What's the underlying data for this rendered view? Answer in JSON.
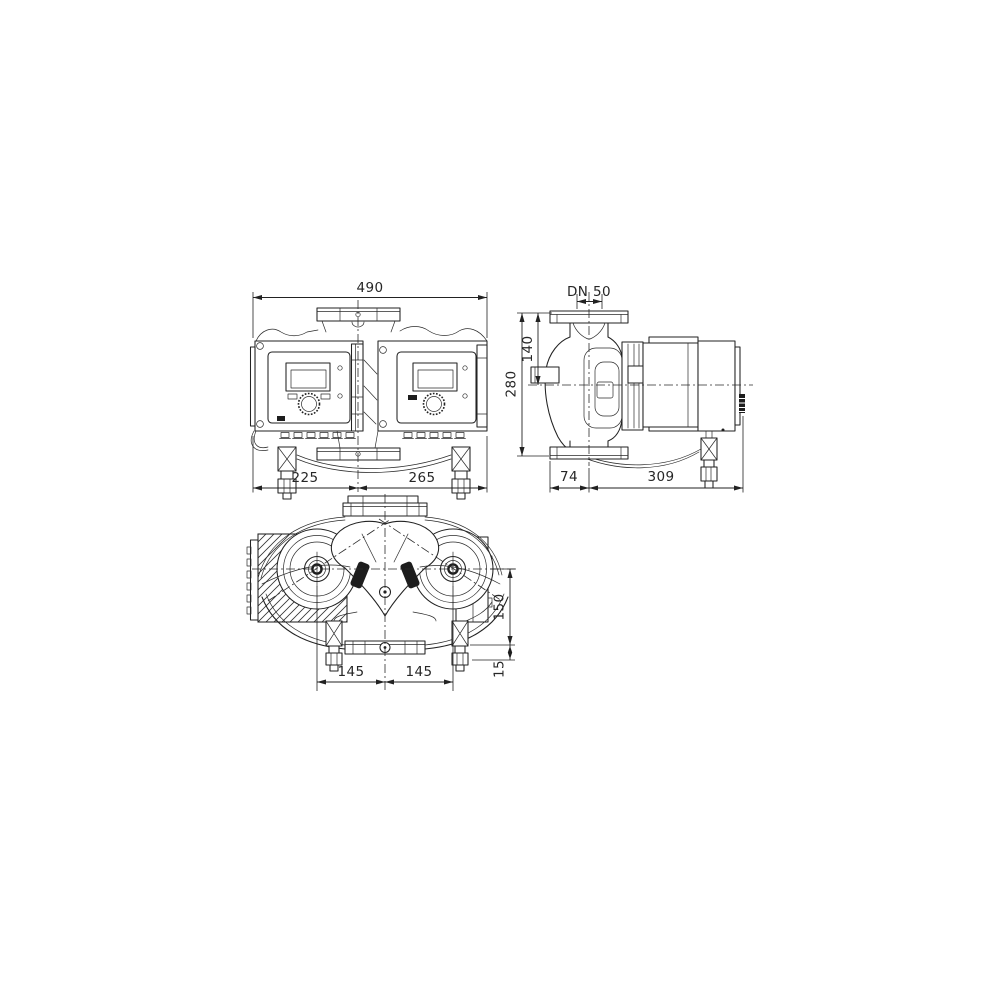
{
  "drawing": {
    "background": "#ffffff",
    "line_color": "#222222",
    "views": {
      "front": {
        "dims": {
          "overall_width": "490",
          "center_to_left_edge": "225",
          "center_to_right_edge": "265"
        }
      },
      "side": {
        "dims": {
          "flange_dn": "DN 50",
          "flange_to_shaft_axis": "140",
          "overall_height": "280",
          "axis_to_flange_edge": "74",
          "axis_to_motor_end": "309"
        }
      },
      "plan": {
        "dims": {
          "left_motor_offset": "145",
          "right_motor_offset": "145",
          "shaft_to_flange_depth": "150",
          "foot_offset": "15"
        }
      }
    }
  }
}
